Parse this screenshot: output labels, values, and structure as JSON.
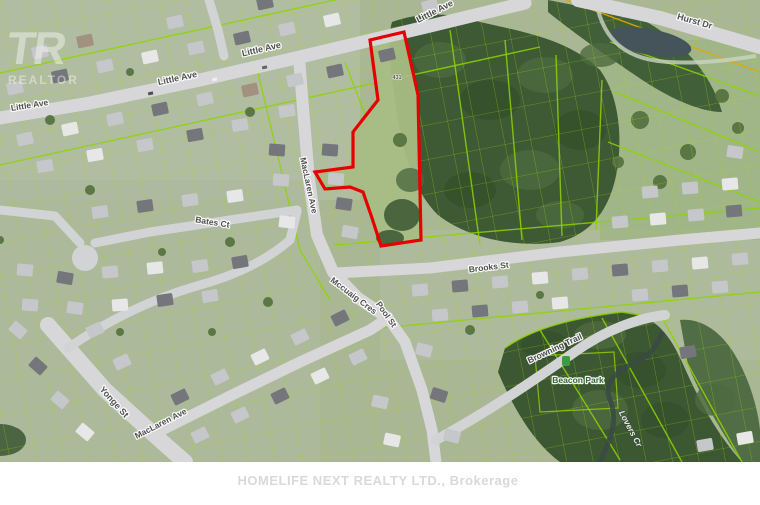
{
  "map": {
    "street_labels": {
      "little_ave": "Little Ave",
      "hurst_dr": "Hurst Dr",
      "yonge_st": "Yonge St",
      "maclaren_ave": "MacLaren Ave",
      "bates_ct": "Bates Ct",
      "brooks_st": "Brooks St",
      "mccuaig_cres": "Mccuaig Cres",
      "pool_st": "Pool St",
      "browning_trail": "Browning Trail"
    },
    "place_labels": {
      "park": "Beacon Park",
      "creek": "Lovers Cr",
      "house_number": "431"
    },
    "colors": {
      "property_outline_red": "#e60000",
      "parcel_line_green": "#9edc00",
      "road_gray": "#d7d7d9",
      "forest_green": "#3d5a35",
      "water_gray": "#44545a"
    },
    "watermarks": {
      "board_logo_letters": "TR",
      "board_logo_wordmark": "REALTOR",
      "brokerage_line": "HOMELIFE NEXT REALTY LTD., Brokerage"
    }
  }
}
